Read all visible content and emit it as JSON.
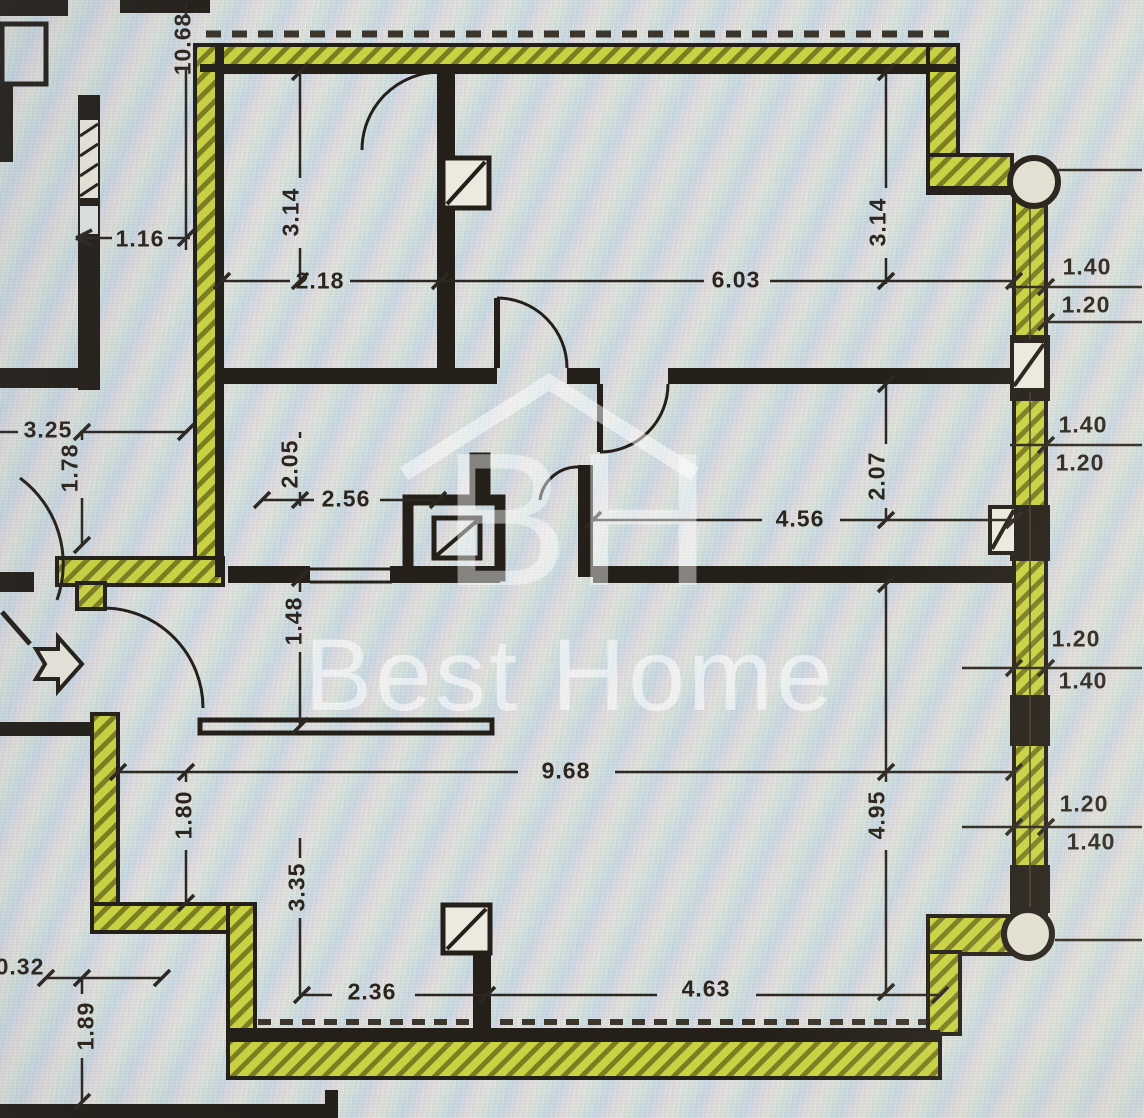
{
  "watermark": {
    "monogram": "BH",
    "brand": "Best Home"
  },
  "dims": [
    "10.68",
    "1.16",
    "3.14",
    "2.18",
    "6.03",
    "3.14",
    "1.40",
    "1.20",
    "3.25",
    "1.78",
    "2.05",
    "2.56",
    "2.07",
    "4.56",
    "1.40",
    "1.20",
    "1.48",
    "1.20",
    "1.40",
    "9.68",
    "4.95",
    "1.20",
    "1.40",
    "1.80",
    "3.35",
    "2.36",
    "4.63",
    "0.32",
    "1.89"
  ],
  "colors": {
    "wall": "#241f19",
    "highlight_fill": "#c9d243",
    "highlight_hatch": "#7c7d20",
    "dimension_text": "#2c251d",
    "background": "#d9dddd",
    "watermark": "#ffffff"
  }
}
